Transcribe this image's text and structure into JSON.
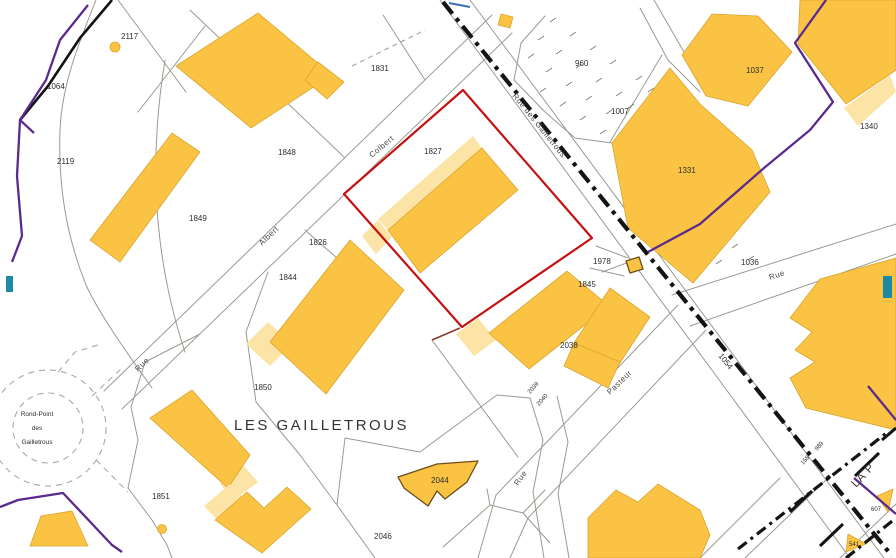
{
  "map": {
    "highlighted_parcel": "1827",
    "colors": {
      "bg": "#ffffff",
      "building": "#fbc343",
      "building_light": "#fce3a6",
      "outline": "#d9a52e",
      "outline_dark": "#6b4e16",
      "parcel_line": "#9a9a91",
      "road_black": "#141414",
      "boundary_red": "#c41111",
      "boundary_purple": "#5a2b8c",
      "marker_teal": "#1e89a6",
      "label": "#2e2e2e",
      "street_label": "#4a4a4a"
    },
    "place_labels": [
      {
        "text": "LES GAILLETROUS"
      },
      {
        "text": "Rond-Point"
      },
      {
        "text": "des"
      },
      {
        "text": "Gailletrous"
      },
      {
        "text": "LA P"
      }
    ],
    "street_labels": [
      {
        "text": "Rue des Gailletrous"
      },
      {
        "text": "Colbert"
      },
      {
        "text": "Albert"
      },
      {
        "text": "Rue"
      },
      {
        "text": "Rue"
      },
      {
        "text": "Rue"
      },
      {
        "text": "Pasteur"
      }
    ],
    "parcel_labels": [
      {
        "text": "2117"
      },
      {
        "text": "1064"
      },
      {
        "text": "2119"
      },
      {
        "text": "1831"
      },
      {
        "text": "1848"
      },
      {
        "text": "1827"
      },
      {
        "text": "960"
      },
      {
        "text": "1007"
      },
      {
        "text": "1037"
      },
      {
        "text": "1331"
      },
      {
        "text": "1340"
      },
      {
        "text": "1849"
      },
      {
        "text": "1826"
      },
      {
        "text": "1844"
      },
      {
        "text": "1978"
      },
      {
        "text": "1845"
      },
      {
        "text": "1036"
      },
      {
        "text": "2038"
      },
      {
        "text": "1850"
      },
      {
        "text": "1851"
      },
      {
        "text": "2044"
      },
      {
        "text": "2046"
      },
      {
        "text": "1054"
      },
      {
        "text": "2039"
      },
      {
        "text": "2040"
      },
      {
        "text": "158"
      },
      {
        "text": "989"
      },
      {
        "text": "607"
      },
      {
        "text": "541"
      }
    ]
  }
}
